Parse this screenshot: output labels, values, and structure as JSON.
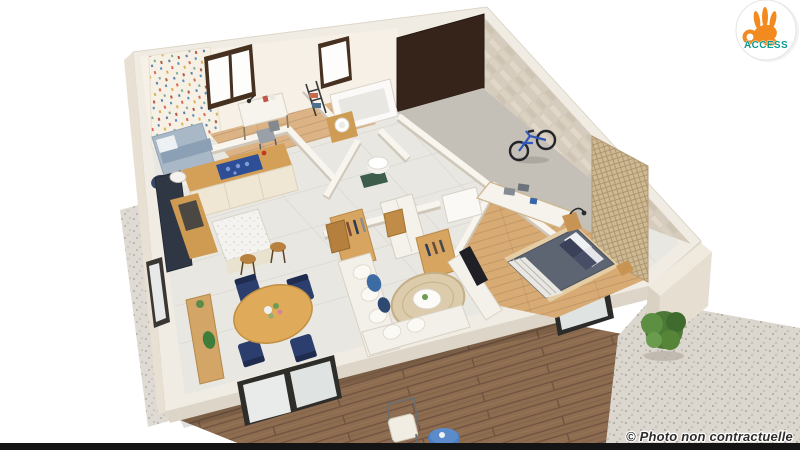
{
  "page": {
    "width": 800,
    "height": 450,
    "background": "#ffffff"
  },
  "branding": {
    "logo_text": "ACCESS",
    "logo_icon": "ok-hand-icon",
    "badge_bg": "#ffffff",
    "hand_orange": "#F28A1F",
    "text_teal": "#0C9B8E"
  },
  "watermark": {
    "text": "© Photo non contractuelle",
    "color": "#2e2d2b"
  },
  "scene": {
    "kind": "3D floor plan render of a single-storey home, viewed from above",
    "rooms": [
      "kids-bedroom",
      "bathroom",
      "wc",
      "dressing",
      "hallway",
      "garage",
      "kitchen",
      "dining-area",
      "living-room",
      "master-bedroom"
    ],
    "exterior": [
      "wood-deck",
      "gravel-patio",
      "shrub",
      "outdoor-chair",
      "outdoor-side-table",
      "gravel-path"
    ],
    "objects": [
      "bicycle",
      "bathtub",
      "washbasin",
      "kids-bed",
      "desk",
      "kitchen-island",
      "bar-stools",
      "round-dining-table",
      "navy-chairs",
      "sofa",
      "round-rug",
      "coffee-table",
      "tv-console",
      "double-bed",
      "wardrobes",
      "slatted-screen",
      "sideboard-with-towels"
    ],
    "palette": {
      "background": "#ffffff",
      "wall": "#f1ece3",
      "wall_shadow": "#ddd5c7",
      "stone_wall": "#d6ccbd",
      "tile_floor": "#e9e7e2",
      "grout": "#dcd9d2",
      "wood_floor": "#d8ab74",
      "kid_wood": "#dcb385",
      "garage_floor": "#c4c0b7",
      "garage_door": "#36241b",
      "window_frame": "#46301f",
      "wallpaper_base": "#f6f1e4",
      "kitchen_wood": "#d49f57",
      "cabinet_cream": "#efe7d4",
      "cooktop_blue": "#2e4f96",
      "appliance_dark": "#2f3745",
      "chair_navy": "#2c3e6d",
      "dining_wood": "#dfaa5a",
      "console_wood": "#d3a566",
      "sofa_white": "#f3f0e9",
      "cushion_blue": "#3d6ca5",
      "rug_jute": "#dcccab",
      "tv_dark": "#1f2026",
      "bed_duvet": "#5d6472",
      "pillow_navy": "#3a4158",
      "wardrobe_white": "#f6f3ed",
      "slat_screen": "#cdb993",
      "deck_wood": "#8d6c50",
      "gravel": "#dbd7cf",
      "plant_green": "#4c7a36",
      "outdoor_table_blue": "#4a7fc1",
      "bottom_bar": "#141414"
    }
  }
}
